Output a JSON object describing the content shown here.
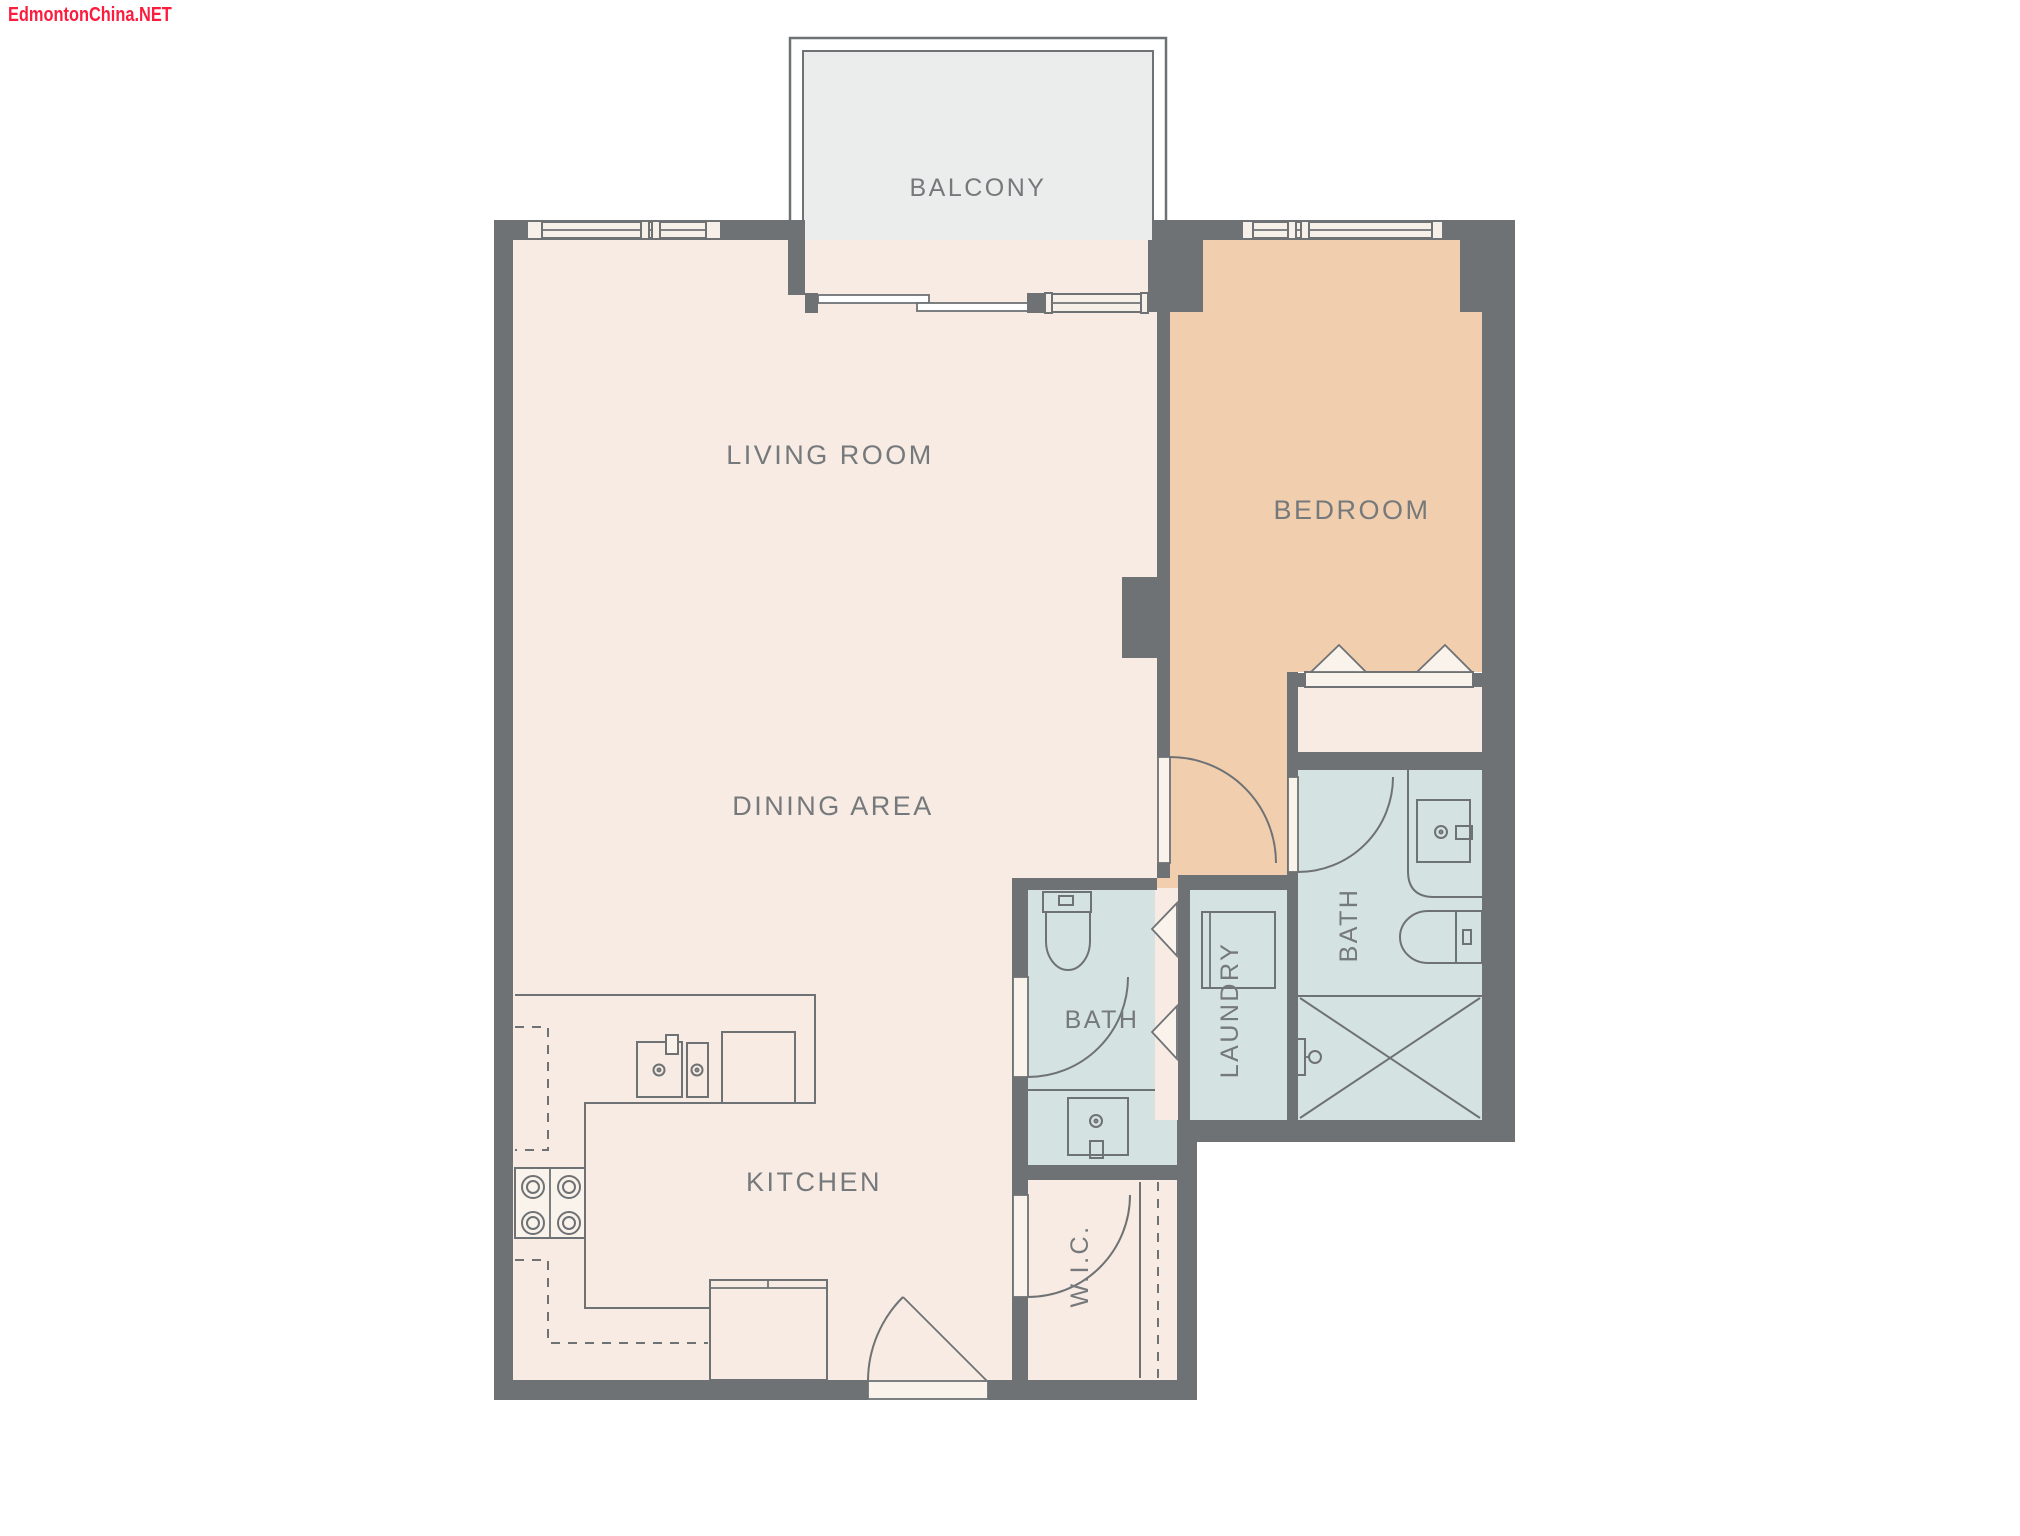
{
  "watermark": {
    "text": "EdmontonChina.NET"
  },
  "rooms": {
    "balcony": {
      "label": "BALCONY"
    },
    "living_room": {
      "label": "LIVING ROOM"
    },
    "bedroom": {
      "label": "BEDROOM"
    },
    "dining_area": {
      "label": "DINING AREA"
    },
    "kitchen": {
      "label": "KITCHEN"
    },
    "bath_main": {
      "label": "BATH"
    },
    "bath_ensuite": {
      "label": "BATH"
    },
    "laundry": {
      "label": "LAUNDRY"
    },
    "walk_in_closet": {
      "label": "W.I.C."
    }
  },
  "colors": {
    "wall": "#6f7275",
    "floor": "#f7ebe3",
    "bedroom_floor": "#f1cfae",
    "bath_floor": "#d4e2e1",
    "balcony_floor": "#ebedec",
    "window_fill": "#f7f0e9",
    "fixture_fill": "#faf3ec",
    "label": "#76797c",
    "watermark": "#fb1c3e"
  }
}
